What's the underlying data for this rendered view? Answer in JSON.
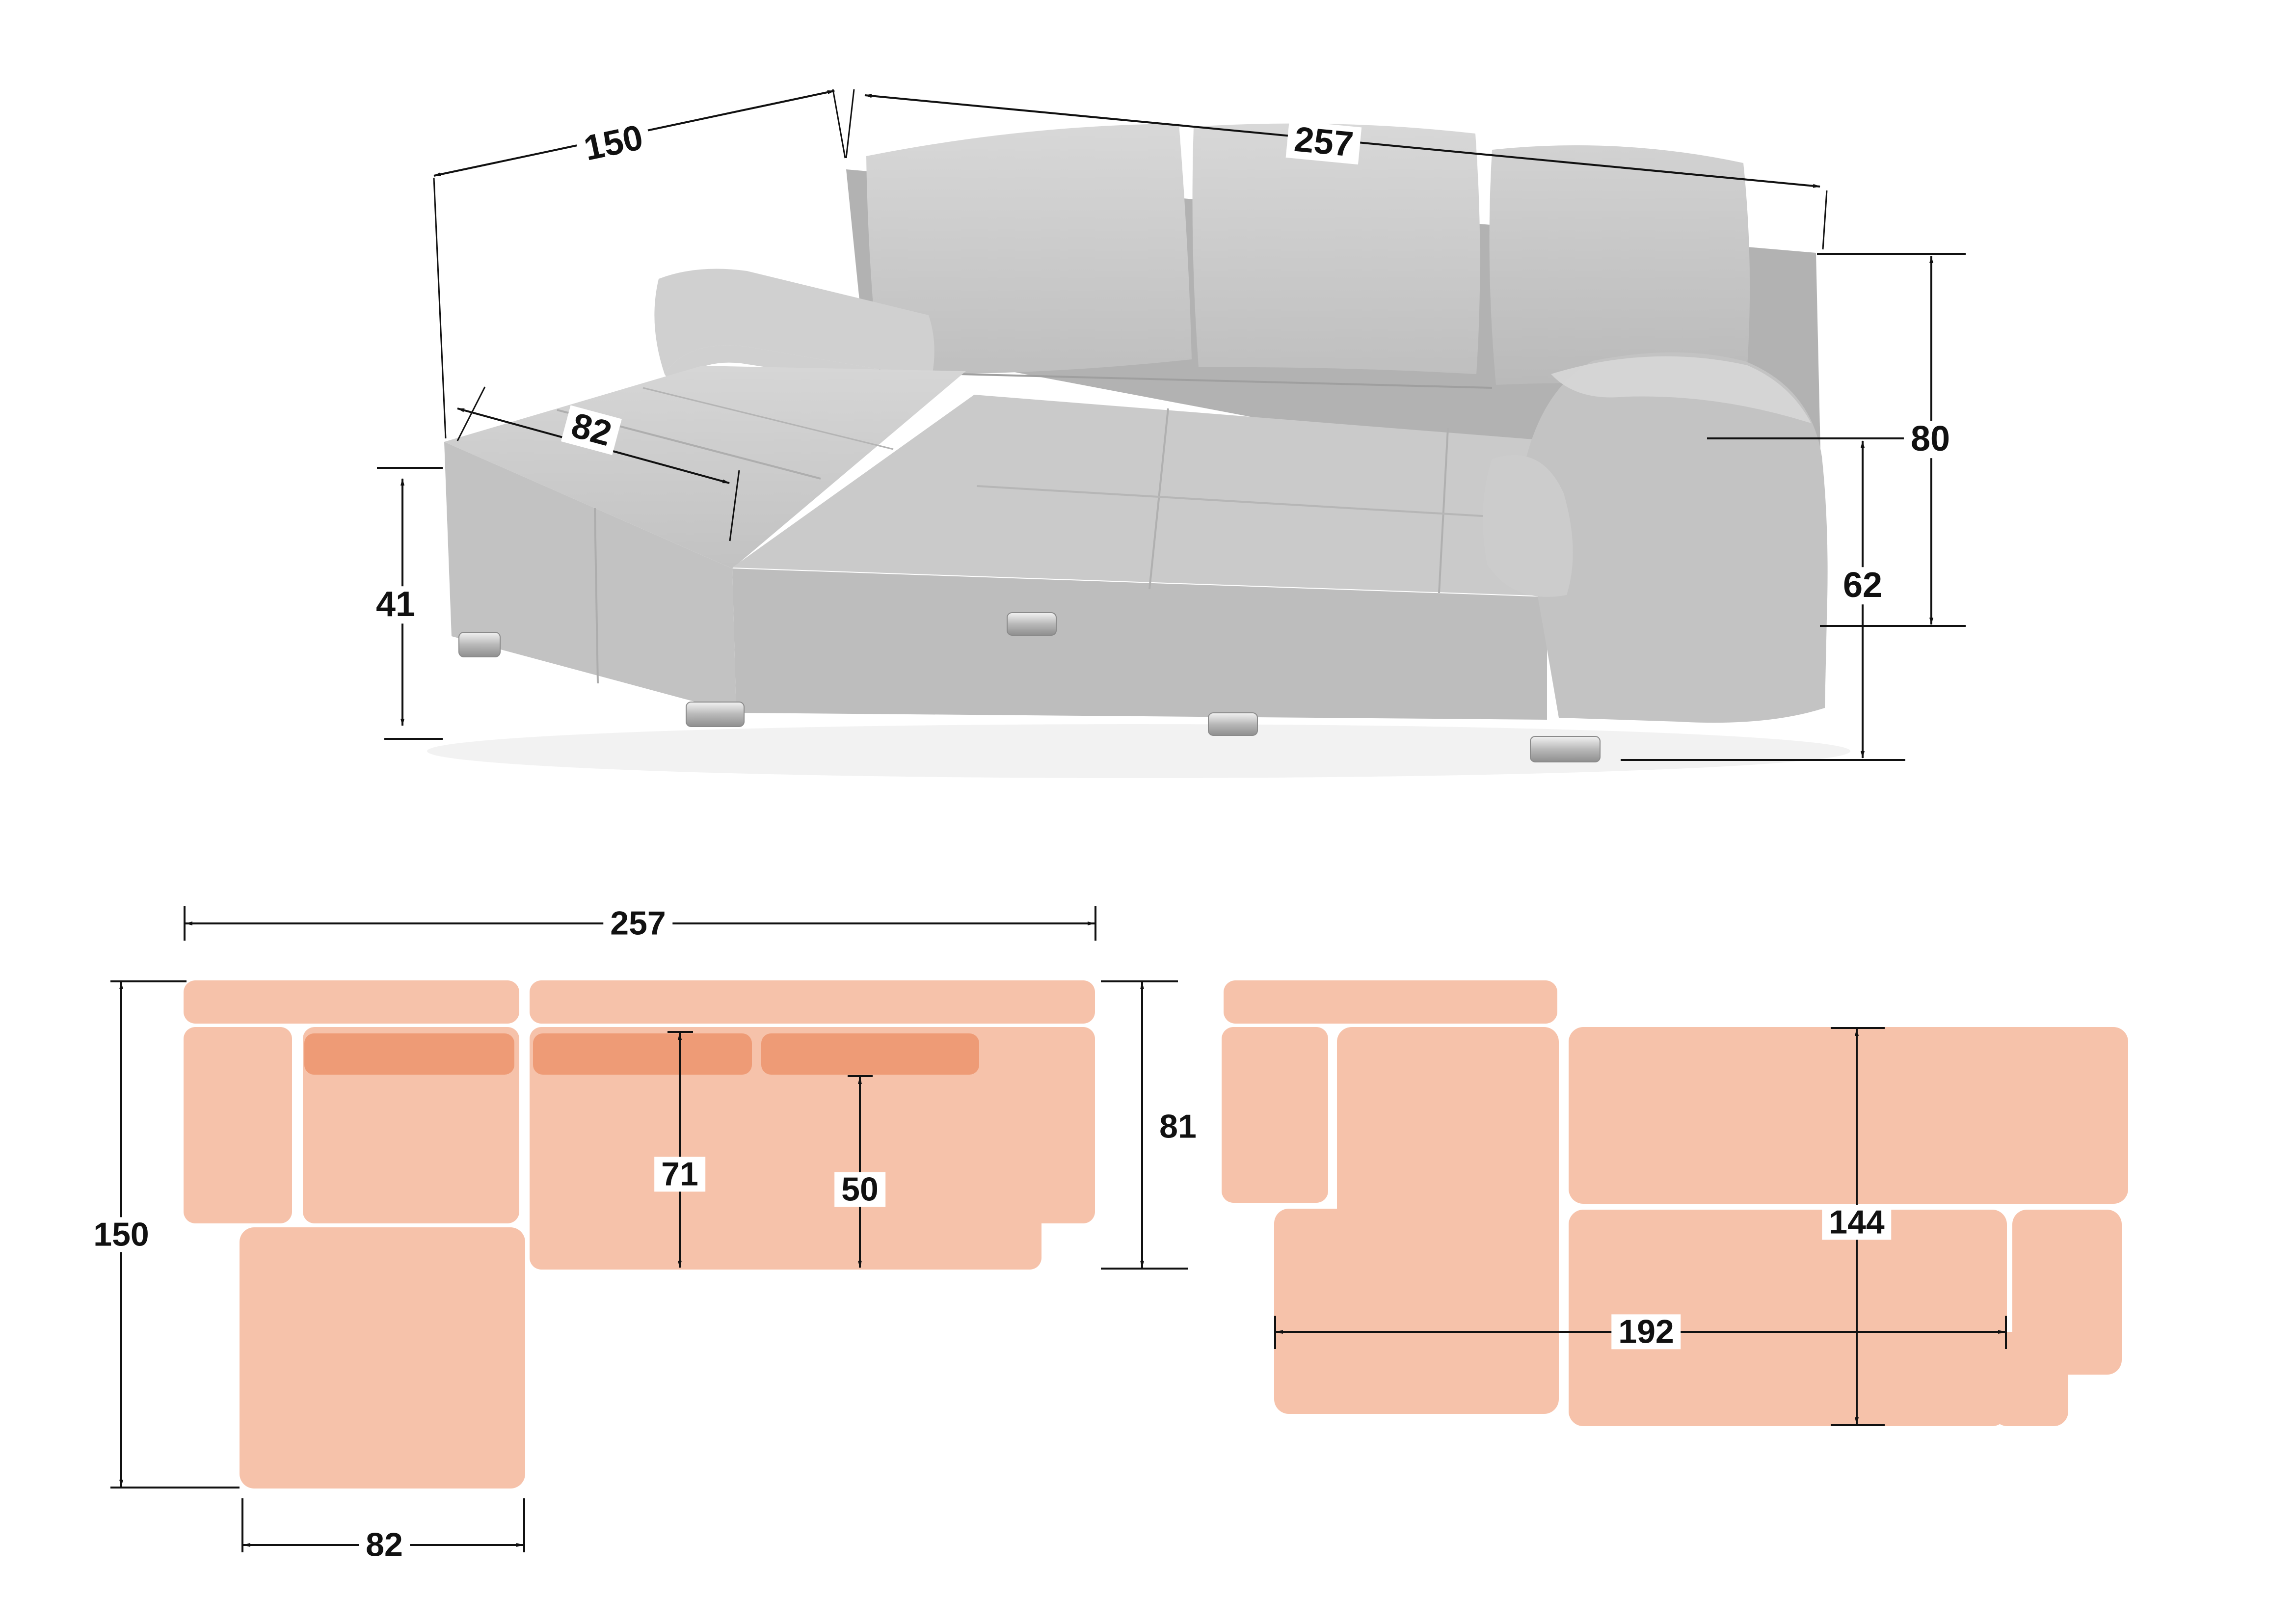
{
  "dimensions": {
    "photo": {
      "chaise_length": "150",
      "total_width": "257",
      "chaise_seat_width": "82",
      "seat_height": "41",
      "back_height": "80",
      "arm_height": "62"
    },
    "floor_plan": {
      "total_width": "257",
      "total_depth": "150",
      "chaise_width": "82",
      "overall_depth": "81",
      "seat_depth_full": "71",
      "seat_depth_cushion": "50"
    },
    "bed_plan": {
      "bed_length": "192",
      "bed_width": "144"
    }
  },
  "colors": {
    "plan_light": "#F6C2AA",
    "plan_dark": "#EE9B76",
    "line": "#111111",
    "fabric_light": "#d4d4d4",
    "fabric_mid": "#c6c6c6",
    "fabric_dark": "#b0b0b0"
  }
}
